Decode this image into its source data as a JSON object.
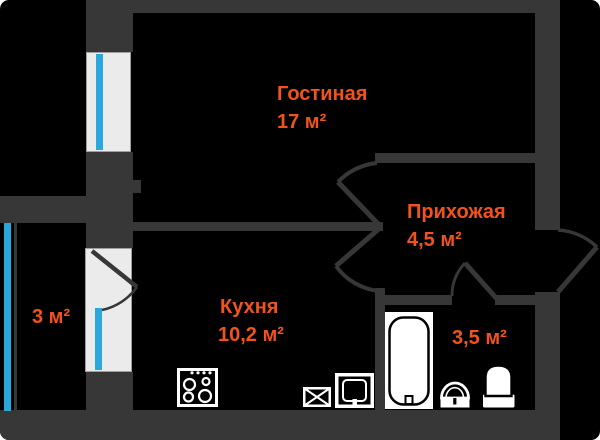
{
  "rooms": {
    "living": {
      "label": "Гостиная",
      "area": "17 м²"
    },
    "hallway": {
      "label": "Прихожая",
      "area": "4,5 м²"
    },
    "kitchen": {
      "label": "Кухня",
      "area": "10,2 м²"
    },
    "bathroom": {
      "area": "3,5 м²"
    },
    "balcony": {
      "area": "3 м²"
    }
  },
  "icons": {
    "stove": "stove-icon",
    "extractor": "extractor-vent-icon",
    "kitchen_sink": "kitchen-sink-icon",
    "bathtub": "bathtub-icon",
    "washbasin": "washbasin-icon",
    "toilet": "toilet-icon"
  },
  "colors": {
    "background": "#000000",
    "wall": "#373737",
    "room_label": "#f1531d",
    "glazing": "#2aa7dc",
    "window_fill": "#ebebeb",
    "fixture": "#ffffff"
  }
}
